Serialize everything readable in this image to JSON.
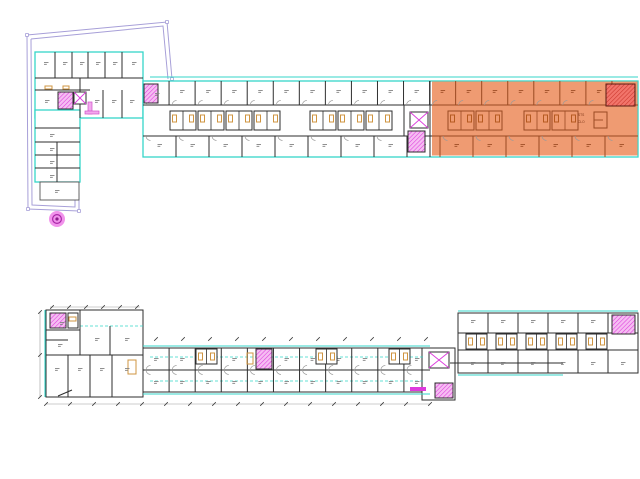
{
  "canvas": {
    "w": 640,
    "h": 479,
    "bg": "#ffffff"
  },
  "palette": {
    "boundary": "#a79fd8",
    "cyan": "#35d6c9",
    "wall": "#2e2e2e",
    "wallOrange": "#9a4a22",
    "grayWall": "#555555",
    "orangeFill": "#ee9266",
    "redFill": "#f2756b",
    "redHatch": "#c9352b",
    "magenta": "#dd3bdd",
    "magentaFill": "#f6bdf2",
    "tan": "#cf9440",
    "tanOrange": "#b55a20",
    "dim": "#9a9a9a",
    "tick": "#3a3a3a",
    "labelMark": "#848484",
    "labelMarkOrange": "#a05028",
    "doorArc": "#9a9a9a"
  },
  "site_boundary": {
    "paths": [
      "M27,35 L167,22 L172,79",
      "M27,35 L28,209 L79,211 L79,193",
      "M31,39 L163,26 L168,79",
      "M31,39 L32,205 L75,207 L75,193"
    ],
    "markers": [
      [
        27,
        35
      ],
      [
        167,
        22
      ],
      [
        172,
        79
      ],
      [
        28,
        209
      ],
      [
        79,
        211
      ]
    ],
    "tree": {
      "cx": 57,
      "cy": 219,
      "r": 8
    }
  },
  "upper_plan": {
    "cyan_rects": [
      [
        35,
        52,
        108,
        66
      ],
      [
        35,
        110,
        45,
        72
      ],
      [
        143,
        81,
        495,
        76
      ]
    ],
    "cyan_lines": [
      [
        150,
        77,
        638,
        77
      ]
    ],
    "gray_rects": [
      [
        40,
        182,
        39,
        18
      ]
    ],
    "selection": {
      "x": 432,
      "y": 81.5,
      "w": 205.5,
      "h": 74
    },
    "red_room": {
      "x": 606,
      "y": 84,
      "w": 29,
      "h": 22
    },
    "walls": [
      [
        55,
        52,
        55,
        78
      ],
      [
        72,
        52,
        72,
        78
      ],
      [
        88,
        52,
        88,
        78
      ],
      [
        105,
        52,
        105,
        78
      ],
      [
        122,
        52,
        122,
        78
      ],
      [
        35,
        78,
        143,
        78
      ],
      [
        35,
        90,
        90,
        90
      ],
      [
        80,
        78,
        80,
        118
      ],
      [
        103,
        90,
        103,
        118
      ],
      [
        122,
        90,
        122,
        118
      ],
      [
        35,
        128,
        80,
        128
      ],
      [
        35,
        142,
        80,
        142
      ],
      [
        35,
        155,
        80,
        155
      ],
      [
        35,
        168,
        80,
        168
      ],
      [
        57,
        142,
        57,
        182
      ],
      [
        430,
        81,
        430,
        157
      ],
      [
        404,
        105,
        404,
        136
      ]
    ],
    "hwalls_split": [
      [
        143,
        105,
        638
      ],
      [
        143,
        136,
        638
      ]
    ],
    "room_rows": [
      {
        "x0": 143,
        "x1": 638,
        "y0": 81,
        "y1": 105,
        "count": 19,
        "arc": "up",
        "labelY": 90
      },
      {
        "x0": 143,
        "x1": 638,
        "y0": 136,
        "y1": 157,
        "count": 15,
        "arc": "down",
        "labelY": 144
      }
    ],
    "pod_size": [
      26,
      19
    ],
    "pods_white": [
      [
        170,
        111
      ],
      [
        198,
        111
      ],
      [
        226,
        111
      ],
      [
        254,
        111
      ],
      [
        310,
        111
      ],
      [
        338,
        111
      ],
      [
        366,
        111
      ]
    ],
    "pods_orange": [
      [
        448,
        111
      ],
      [
        476,
        111
      ],
      [
        524,
        111
      ],
      [
        552,
        111
      ]
    ],
    "stairs": [
      [
        144,
        84,
        14,
        19
      ],
      [
        58,
        92,
        15,
        17
      ],
      [
        408,
        131,
        17,
        21
      ]
    ],
    "xboxes": [
      [
        74,
        92,
        12,
        12
      ],
      [
        410,
        112,
        18,
        16
      ]
    ],
    "pink_shapes": [
      [
        88,
        102,
        4,
        12
      ],
      [
        85,
        111,
        14,
        3
      ]
    ],
    "tan_marks": [
      [
        45,
        86,
        7,
        3
      ],
      [
        63,
        86,
        6,
        3
      ]
    ],
    "f_element": {
      "x": 594,
      "y": 112,
      "w": 13,
      "h": 16
    },
    "tiny_texts": [
      {
        "x": 578,
        "y": 116,
        "t": "STS"
      },
      {
        "x": 578,
        "y": 123,
        "t": "CLO"
      }
    ],
    "labels": [
      [
        44,
        62
      ],
      [
        63,
        62
      ],
      [
        80,
        62
      ],
      [
        96,
        62
      ],
      [
        113,
        62
      ],
      [
        132,
        62
      ],
      [
        45,
        100
      ],
      [
        95,
        100
      ],
      [
        112,
        100
      ],
      [
        130,
        100
      ],
      [
        50,
        134
      ],
      [
        50,
        148
      ],
      [
        50,
        161
      ],
      [
        50,
        175
      ],
      [
        55,
        190
      ],
      [
        155,
        93
      ]
    ]
  },
  "lower_plan": {
    "dark_rects": [
      [
        46,
        310,
        97,
        87
      ],
      [
        143,
        348,
        287,
        44
      ],
      [
        458,
        313,
        180,
        60
      ],
      [
        422,
        348,
        33,
        52
      ]
    ],
    "cyan_lines": [
      [
        45,
        310,
        45,
        397
      ],
      [
        143,
        346,
        430,
        346
      ],
      [
        143,
        394,
        430,
        394
      ],
      [
        458,
        311,
        638,
        311
      ],
      [
        458,
        375,
        563,
        375
      ]
    ],
    "dashed_lines": [
      [
        80,
        326,
        143,
        326
      ],
      [
        150,
        357,
        425,
        357
      ],
      [
        150,
        381,
        425,
        381
      ]
    ],
    "walls": [
      [
        46,
        330,
        80,
        330
      ],
      [
        46,
        355,
        143,
        355
      ],
      [
        46,
        340,
        68,
        340
      ],
      [
        80,
        310,
        80,
        355
      ],
      [
        110,
        326,
        110,
        355
      ],
      [
        68,
        355,
        68,
        397
      ],
      [
        90,
        355,
        90,
        397
      ],
      [
        112,
        355,
        112,
        397
      ],
      [
        143,
        370,
        430,
        370
      ],
      [
        458,
        333,
        638,
        333
      ],
      [
        458,
        350,
        638,
        350
      ],
      [
        450,
        363,
        563,
        363
      ],
      [
        58,
        396,
        72,
        390
      ]
    ],
    "room_rows": [
      {
        "x0": 143,
        "x1": 430,
        "y0": 348,
        "y1": 370,
        "count": 11,
        "arc": "up",
        "labelY": 358
      },
      {
        "x0": 143,
        "x1": 430,
        "y0": 370,
        "y1": 392,
        "count": 11,
        "arc": "down",
        "labelY": 381
      },
      {
        "x0": 458,
        "x1": 638,
        "y0": 313,
        "y1": 333,
        "count": 6,
        "arc": "none",
        "labelY": 320
      },
      {
        "x0": 458,
        "x1": 638,
        "y0": 350,
        "y1": 373,
        "count": 6,
        "arc": "none",
        "labelY": 362
      }
    ],
    "pod_size": [
      21,
      15
    ],
    "pods": [
      [
        196,
        349
      ],
      [
        316,
        349
      ],
      [
        389,
        349
      ],
      [
        466,
        334
      ],
      [
        496,
        334
      ],
      [
        526,
        334
      ],
      [
        556,
        334
      ],
      [
        586,
        334
      ]
    ],
    "stairs": [
      [
        50,
        313,
        16,
        15
      ],
      [
        435,
        383,
        18,
        15
      ],
      [
        612,
        315,
        23,
        19
      ],
      [
        256,
        349,
        16,
        20
      ]
    ],
    "xboxes": [
      [
        429,
        352,
        20,
        16
      ]
    ],
    "magenta_solids": [
      [
        410,
        387,
        16,
        4
      ]
    ],
    "shaft_rects": [
      [
        68,
        313,
        10,
        15
      ]
    ],
    "tan_marks": [
      [
        247,
        353,
        6,
        11
      ],
      [
        128,
        360,
        8,
        14
      ],
      [
        69,
        317,
        7,
        4
      ]
    ],
    "labels": [
      [
        58,
        344
      ],
      [
        95,
        338
      ],
      [
        125,
        338
      ],
      [
        55,
        368
      ],
      [
        78,
        368
      ],
      [
        100,
        368
      ],
      [
        125,
        368
      ],
      [
        60,
        322
      ]
    ],
    "dims": {
      "lines": [
        [
          46,
          404,
          430,
          404
        ],
        [
          40,
          312,
          40,
          397
        ],
        [
          50,
          307,
          140,
          307
        ]
      ],
      "ticks_rows": [
        {
          "y": 404,
          "x0": 46,
          "x1": 430,
          "step": 24
        },
        {
          "y": 339,
          "x0": 156,
          "x1": 426,
          "step": 27
        },
        {
          "y": 307,
          "x0": 52,
          "x1": 138,
          "step": 17
        }
      ],
      "ticks_pts": [
        [
          40,
          312
        ],
        [
          40,
          355
        ],
        [
          40,
          397
        ]
      ]
    }
  }
}
